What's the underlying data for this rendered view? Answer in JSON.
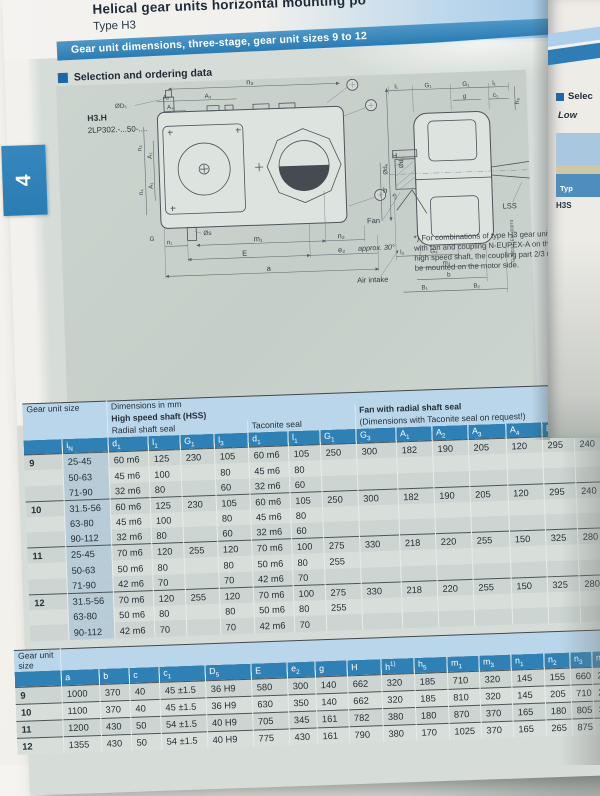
{
  "page": {
    "title": "Helical gear units horizontal mounting po",
    "subtitle": "Type H3",
    "banner": "Gear unit dimensions, three-stage, gear unit sizes 9 to 12",
    "section_heading": "Selection and ordering data",
    "tab_number": "4"
  },
  "drawing": {
    "model": "H3.H",
    "order_code": "2LP302.-...50-....",
    "code_vertical": "G_MD32_EN_00074",
    "footnote": "*) For combinations of type H3 gear units with fan and coupling N-EUPEX-A on the high speed shaft, the coupling part 2/3 must be mounted on the motor side.",
    "labels": {
      "n3": "n₃",
      "a2": "A₂",
      "a3": "A₃",
      "a4": "A₄",
      "d5": "ØD₅",
      "n4": "n₄",
      "a1": "A₁",
      "g_corner": "G",
      "s": "Øs",
      "n1": "n₁",
      "m1": "m₁",
      "n2": "n₂",
      "e": "E",
      "e2": "e₂",
      "a": "a",
      "h_cap": "H",
      "h": "h",
      "h5": "h₅",
      "l1": "l₁",
      "g1": "G₁",
      "g": "g",
      "c1": "c₁",
      "d6": "Ød₆",
      "d1": "Ød₁",
      "l3": "l₃",
      "g3": "G₃",
      "m3": "m₃",
      "b": "b",
      "b1": "B₁",
      "b2": "B₂",
      "fan": "Fan",
      "lss": "LSS",
      "approx": "approx. 30°",
      "air": "Air intake",
      "star": "*)"
    }
  },
  "table1": {
    "group_headers": {
      "gear_unit_size": "Gear unit size",
      "dimensions": "Dimensions in mm",
      "hss": "High speed shaft (HSS)",
      "radial": "Radial shaft seal",
      "taconite": "Taconite seal",
      "fan": "Fan with radial shaft seal",
      "fan_note": "(Dimensions with Taconite seal on request!)"
    },
    "columns": [
      "i|N",
      "d|1",
      "l|1",
      "G|1",
      "l|3",
      "d|1",
      "l|1",
      "G|1",
      "G|3",
      "A|1",
      "A|2",
      "A|3",
      "A|4",
      "B|1",
      "B|2",
      ""
    ],
    "groups": [
      {
        "size": "9",
        "rows": [
          [
            "25-45",
            "60 m6",
            "125",
            "230",
            "105",
            "60 m6",
            "105",
            "250",
            "300",
            "182",
            "190",
            "205",
            "120",
            "295",
            "240",
            ""
          ],
          [
            "50-63",
            "45 m6",
            "100",
            "",
            "80",
            "45 m6",
            "80",
            "",
            "",
            "",
            "",
            "",
            "",
            "",
            "",
            ""
          ],
          [
            "71-90",
            "32 m6",
            "80",
            "",
            "60",
            "32 m6",
            "60",
            "",
            "",
            "",
            "",
            "",
            "",
            "",
            "",
            ""
          ]
        ]
      },
      {
        "size": "10",
        "rows": [
          [
            "31.5-56",
            "60 m6",
            "125",
            "230",
            "105",
            "60 m6",
            "105",
            "250",
            "300",
            "182",
            "190",
            "205",
            "120",
            "295",
            "240",
            ""
          ],
          [
            "63-80",
            "45 m6",
            "100",
            "",
            "80",
            "45 m6",
            "80",
            "",
            "",
            "",
            "",
            "",
            "",
            "",
            "",
            ""
          ],
          [
            "90-112",
            "32 m6",
            "80",
            "",
            "60",
            "32 m6",
            "60",
            "",
            "",
            "",
            "",
            "",
            "",
            "",
            "",
            ""
          ]
        ]
      },
      {
        "size": "11",
        "rows": [
          [
            "25-45",
            "70 m6",
            "120",
            "255",
            "120",
            "70 m6",
            "100",
            "275",
            "330",
            "218",
            "220",
            "255",
            "150",
            "325",
            "280",
            ""
          ],
          [
            "50-63",
            "50 m6",
            "80",
            "",
            "80",
            "50 m6",
            "80",
            "255",
            "",
            "",
            "",
            "",
            "",
            "",
            "",
            ""
          ],
          [
            "71-90",
            "42 m6",
            "70",
            "",
            "70",
            "42 m6",
            "70",
            "",
            "",
            "",
            "",
            "",
            "",
            "",
            "",
            ""
          ]
        ]
      },
      {
        "size": "12",
        "rows": [
          [
            "31.5-56",
            "70 m6",
            "120",
            "255",
            "120",
            "70 m6",
            "100",
            "275",
            "330",
            "218",
            "220",
            "255",
            "150",
            "325",
            "280",
            ""
          ],
          [
            "63-80",
            "50 m6",
            "80",
            "",
            "80",
            "50 m6",
            "80",
            "255",
            "",
            "",
            "",
            "",
            "",
            "",
            "",
            ""
          ],
          [
            "90-112",
            "42 m6",
            "70",
            "",
            "70",
            "42 m6",
            "70",
            "",
            "",
            "",
            "",
            "",
            "",
            "",
            "",
            ""
          ]
        ]
      }
    ]
  },
  "table2": {
    "size_header": "Gear unit size",
    "columns": [
      "a",
      "b",
      "c",
      "c|1",
      "D|5",
      "E",
      "e|2",
      "g",
      "H",
      "h^1)",
      "h|5",
      "m|1",
      "m|3",
      "n|1",
      "n|2",
      "n|3",
      "n|4"
    ],
    "rows": [
      [
        "9",
        "1000",
        "370",
        "40",
        "45 ±1.5",
        "36 H9",
        "580",
        "300",
        "140",
        "662",
        "320",
        "185",
        "710",
        "320",
        "145",
        "155",
        "660",
        "245"
      ],
      [
        "10",
        "1100",
        "370",
        "40",
        "45 ±1.5",
        "36 H9",
        "630",
        "350",
        "140",
        "662",
        "320",
        "185",
        "810",
        "320",
        "145",
        "205",
        "710",
        "245"
      ],
      [
        "11",
        "1200",
        "430",
        "50",
        "54 ±1.5",
        "40 H9",
        "705",
        "345",
        "161",
        "782",
        "380",
        "180",
        "870",
        "370",
        "165",
        "180",
        "805",
        "300"
      ],
      [
        "12",
        "1355",
        "430",
        "50",
        "54 ±1.5",
        "40 H9",
        "775",
        "430",
        "161",
        "790",
        "380",
        "170",
        "1025",
        "370",
        "165",
        "265",
        "875",
        "300"
      ]
    ]
  },
  "right_page": {
    "heading": "Selec",
    "line2": "Low",
    "box_label": "Typ",
    "box_code": "H3S"
  },
  "colors": {
    "banner_blue": "#2b7cb3",
    "header_cell_blue": "#2f81b5",
    "light_blue_band": "#b9d6ea",
    "page_bg": "#d6dcd8",
    "tab_blue": "#2b7cb3",
    "row_dark": "#ccd5d1",
    "row_light": "#d8dfdb",
    "in_column_bg": "#b7ccd7"
  }
}
